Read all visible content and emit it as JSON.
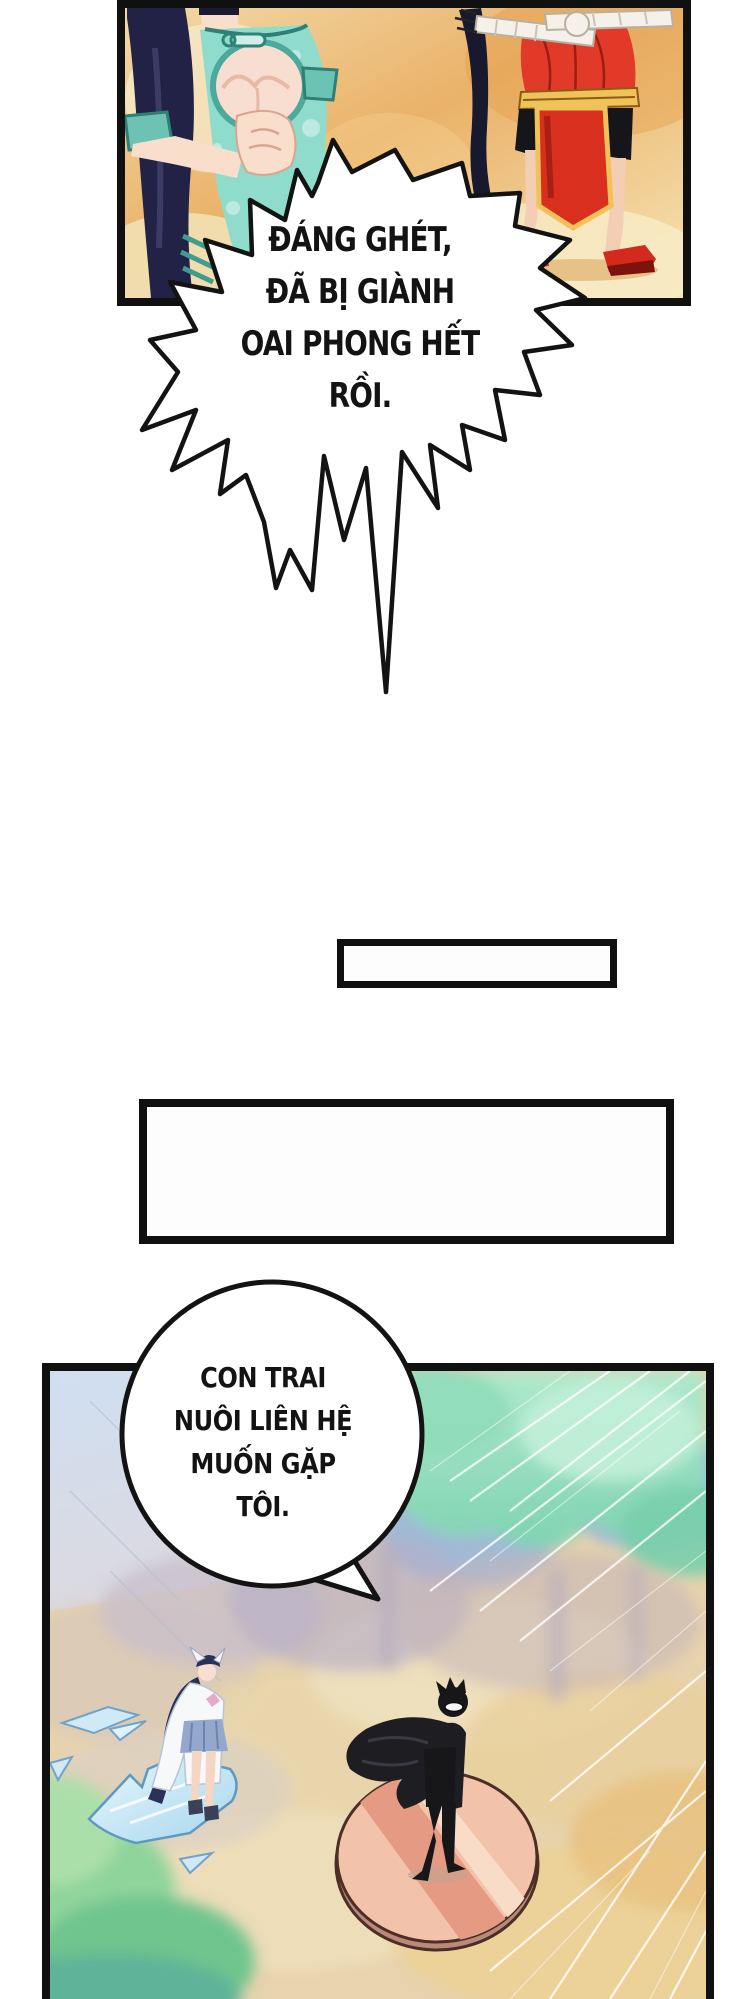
{
  "comic": {
    "shout_bubble": {
      "lines": [
        "ĐÁNG GHÉT,",
        "ĐÃ BỊ GIÀNH",
        "OAI PHONG HẾT",
        "RỒI."
      ]
    },
    "talk_bubble": {
      "lines": [
        "CON TRAI",
        "NUÔI LIÊN HỆ",
        "MUỐN GẶP",
        "TÔI."
      ]
    },
    "caption_boxes": {
      "small_text": "",
      "large_text": ""
    }
  },
  "colors": {
    "panel_border": "#101010",
    "top_panel_orange": "#eab269",
    "qipao_teal": "#8fdccc",
    "qipao_trim": "#2e7f74",
    "dress_red": "#e23a28",
    "sash_gold": "#f0c25a",
    "hair_navy": "#222246",
    "skin": "#f6d7c4",
    "sky_blue": "#cfdff2",
    "foliage_mint": "#a6e6c5",
    "haze_tan": "#e6d0a6",
    "platform_pink": "#f2c3aa",
    "platform_stripe": "#e59b83",
    "ice_blue": "#cfe9f6",
    "speech_text": "#131313"
  }
}
